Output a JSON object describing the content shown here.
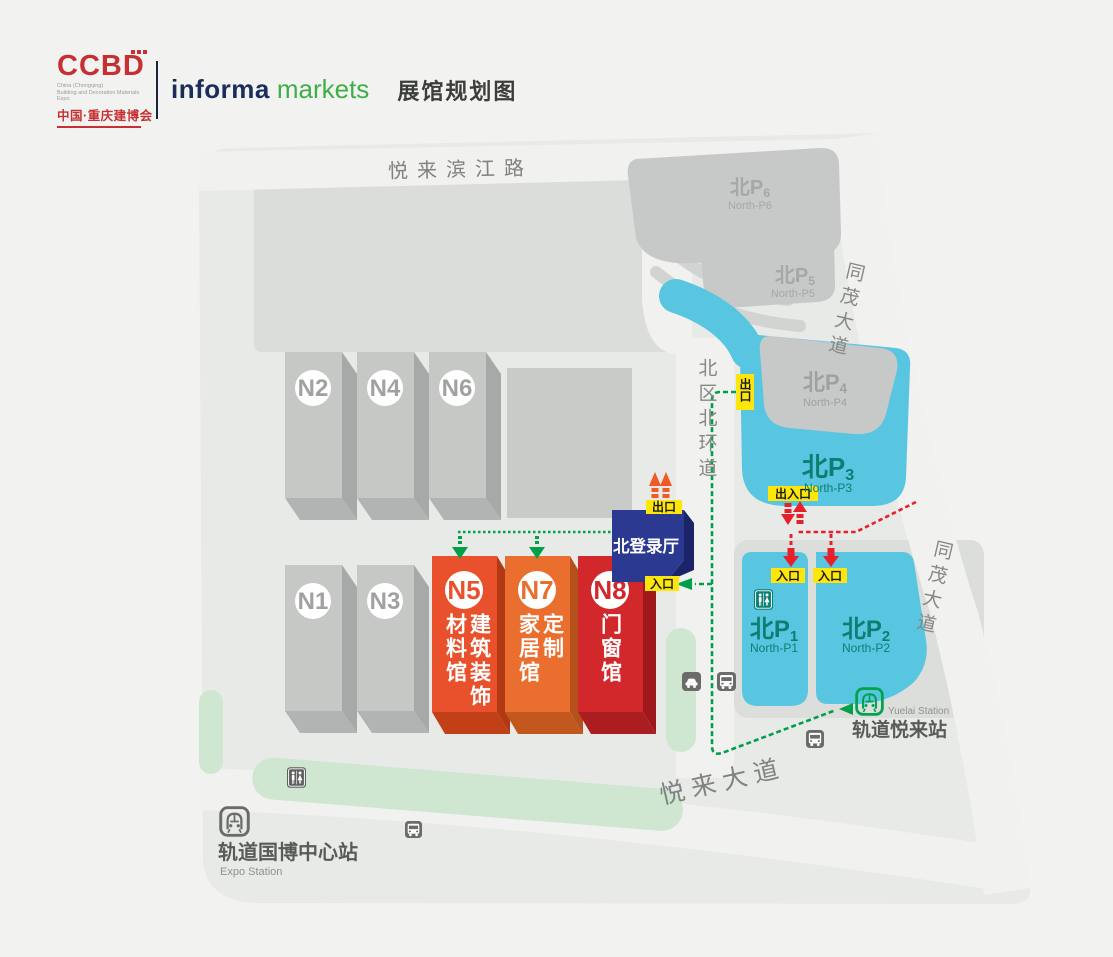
{
  "header": {
    "brand": "CCBD",
    "brand_sub_en_1": "China (Chongqing)",
    "brand_sub_en_2": "Building and Decoration Materials Expo",
    "brand_sub_cn": "中国·重庆建博会",
    "partner_word_1": "informa",
    "partner_word_2": "markets",
    "page_title": "展馆规划图"
  },
  "map": {
    "roads": {
      "riverside": "悦来滨江路",
      "tongmao_upper": "同茂大道",
      "tongmao_lower": "同茂大道",
      "north_ring": "北区北环道",
      "yuelai": "悦来大道"
    },
    "parking": [
      {
        "name": "北P",
        "num": "6",
        "sub": "North-P6"
      },
      {
        "name": "北P",
        "num": "5",
        "sub": "North-P5"
      },
      {
        "name": "北P",
        "num": "4",
        "sub": "North-P4"
      },
      {
        "name": "北P",
        "num": "3",
        "sub": "North-P3"
      },
      {
        "name": "北P",
        "num": "1",
        "sub": "North-P1"
      },
      {
        "name": "北P",
        "num": "2",
        "sub": "North-P2"
      }
    ],
    "gray_halls": [
      "N2",
      "N4",
      "N6",
      "N1",
      "N3"
    ],
    "halls": [
      {
        "id": "N5",
        "col_right": "建筑装饰",
        "col_left": "材料馆"
      },
      {
        "id": "N7",
        "col_right": "定制",
        "col_left": "家居馆"
      },
      {
        "id": "N8",
        "col_right": "门窗馆",
        "col_left": ""
      }
    ],
    "registration_hall": "北登录厅",
    "markers": {
      "exit": "出口",
      "entrance": "入口",
      "exit_entrance": "出入口"
    },
    "stations": {
      "expo": {
        "name": "轨道国博中心站",
        "sub": "Expo Station"
      },
      "yuelai": {
        "name": "轨道悦来站",
        "sub": "Yuelai Station"
      }
    }
  },
  "colors": {
    "brand_red": "#c63032",
    "brand_navy": "#1b2e5a",
    "brand_green": "#3fae49",
    "hall_n5": "#e8512b",
    "hall_n7": "#ea6e2e",
    "hall_n8": "#d2282b",
    "registration_navy": "#2b3990",
    "parking_blue": "#58c6e0",
    "parking_text_teal": "#0c7f72",
    "route_green": "#00a04b",
    "route_red": "#e7212b",
    "marker_yellow": "#ffe60a",
    "exit_arrow_orange": "#f15a24",
    "map_ground": "#e8eae8",
    "green_strip": "#cfe6d1"
  }
}
